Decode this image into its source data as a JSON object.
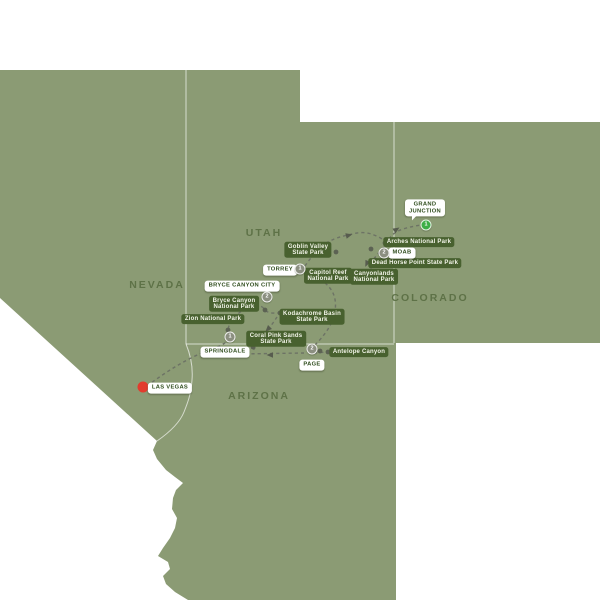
{
  "map": {
    "colors": {
      "land": "#8b9b74",
      "outside": "#ffffff",
      "state_border": "rgba(255,255,255,0.65)",
      "pill_bg": "#48612f",
      "pill_text": "#f2f4e8",
      "city_text": "#2f4d1d",
      "state_label": "#5e7247",
      "route_dash": "#6d7365",
      "stop_dot": "#5c6253",
      "arrow": "#575c4e",
      "badge_gray": "#8b8f80",
      "badge_green": "#3cae46",
      "start_red": "#e23b2d"
    },
    "state_labels": [
      {
        "id": "nevada",
        "name": "NEVADA",
        "x": 156,
        "y": 285
      },
      {
        "id": "utah",
        "name": "UTAH",
        "x": 263,
        "y": 233
      },
      {
        "id": "colorado",
        "name": "COLORADO",
        "x": 429,
        "y": 298
      },
      {
        "id": "arizona",
        "name": "ARIZONA",
        "x": 258,
        "y": 396
      }
    ],
    "park_labels": [
      {
        "id": "goblin-valley",
        "text": "Goblin Valley\nState Park",
        "x": 308,
        "y": 250
      },
      {
        "id": "capitol-reef",
        "text": "Capitol Reef\nNational Park",
        "x": 328,
        "y": 276
      },
      {
        "id": "arches",
        "text": "Arches National Park",
        "x": 419,
        "y": 242
      },
      {
        "id": "dead-horse-point",
        "text": "Dead Horse Point State Park",
        "x": 415,
        "y": 263
      },
      {
        "id": "canyonlands",
        "text": "Canyonlands\nNational Park",
        "x": 374,
        "y": 277
      },
      {
        "id": "kodachrome-basin",
        "text": "Kodachrome Basin\nState Park",
        "x": 312,
        "y": 317
      },
      {
        "id": "bryce-canyon-np",
        "text": "Bryce Canyon\nNational Park",
        "x": 234,
        "y": 304
      },
      {
        "id": "zion",
        "text": "Zion National Park",
        "x": 213,
        "y": 319
      },
      {
        "id": "coral-pink-sands",
        "text": "Coral Pink Sands\nState Park",
        "x": 276,
        "y": 339
      },
      {
        "id": "antelope-canyon",
        "text": "Antelope Canyon",
        "x": 359,
        "y": 352
      }
    ],
    "city_labels": [
      {
        "id": "grand-junction",
        "text": "GRAND\nJUNCTION",
        "x": 425,
        "y": 208,
        "tail": true
      },
      {
        "id": "moab",
        "text": "MOAB",
        "x": 402,
        "y": 253,
        "tail": false
      },
      {
        "id": "torrey",
        "text": "TORREY",
        "x": 280,
        "y": 270,
        "tail": false
      },
      {
        "id": "bryce-canyon-city",
        "text": "BRYCE CANYON CITY",
        "x": 242,
        "y": 286,
        "tail": false
      },
      {
        "id": "springdale",
        "text": "SPRINGDALE",
        "x": 225,
        "y": 352,
        "tail": false
      },
      {
        "id": "page",
        "text": "PAGE",
        "x": 312,
        "y": 365,
        "tail": false
      },
      {
        "id": "las-vegas",
        "text": "LAS VEGAS",
        "x": 170,
        "y": 388,
        "tail": false
      }
    ],
    "night_badges": [
      {
        "id": "grand-junction-nights",
        "nights": "1",
        "x": 426,
        "y": 225,
        "color": "green"
      },
      {
        "id": "moab-nights",
        "nights": "2",
        "x": 384,
        "y": 253,
        "color": "gray"
      },
      {
        "id": "torrey-nights",
        "nights": "1",
        "x": 300,
        "y": 269,
        "color": "gray"
      },
      {
        "id": "bryce-canyon-city-nights",
        "nights": "2",
        "x": 267,
        "y": 297,
        "color": "gray"
      },
      {
        "id": "springdale-nights",
        "nights": "1",
        "x": 230,
        "y": 337,
        "color": "gray"
      },
      {
        "id": "page-nights",
        "nights": "2",
        "x": 312,
        "y": 349,
        "color": "gray"
      }
    ],
    "start_city": {
      "id": "las-vegas-start",
      "x": 143,
      "y": 387
    },
    "route_stop_dots": [
      {
        "x": 228,
        "y": 330
      },
      {
        "x": 265,
        "y": 310
      },
      {
        "x": 280,
        "y": 313
      },
      {
        "x": 253,
        "y": 347
      },
      {
        "x": 320,
        "y": 351
      },
      {
        "x": 328,
        "y": 352
      },
      {
        "x": 305,
        "y": 271
      },
      {
        "x": 336,
        "y": 252
      },
      {
        "x": 385,
        "y": 243
      },
      {
        "x": 371,
        "y": 249
      },
      {
        "x": 375,
        "y": 260
      },
      {
        "x": 371,
        "y": 266
      }
    ],
    "route_arrows": [
      {
        "x": 270,
        "y": 327,
        "angle": 135
      },
      {
        "x": 273,
        "y": 355,
        "angle": 180
      },
      {
        "x": 346,
        "y": 236,
        "angle": -14
      },
      {
        "x": 368,
        "y": 261,
        "angle": 115
      },
      {
        "x": 394,
        "y": 231,
        "angle": -33
      }
    ],
    "route_paths": [
      {
        "id": "las-vegas-to-kodachrome",
        "d": "M147,386 C167,371 188,358 207,351 C217,347 224,345 228,340 C231,336 227,335 228,330 C229,321 237,313 247,308 C256,304 262,305 265,310 C269,314 274,313 279,313"
      },
      {
        "id": "bryce-to-coral-pink",
        "d": "M277,317 C273,323 268,330 263,337 C259,343 255,347 253,351"
      },
      {
        "id": "springdale-to-page",
        "d": "M239,354 L304,353"
      },
      {
        "id": "page-to-antelope",
        "d": "M314,353 L327,352"
      },
      {
        "id": "page-to-capitol-reef",
        "d": "M315,345 C322,338 330,328 333,319 C336,310 337,300 332,291 C327,283 317,276 307,271"
      },
      {
        "id": "torrey-to-arches",
        "d": "M305,266 C311,257 319,248 328,242 C337,237 344,236 352,234 C360,232 367,232 374,235 C379,237 383,239 385,242"
      },
      {
        "id": "arches-to-canyonlands",
        "d": "M384,247 C380,251 376,256 373,260 C372,262 371,264 371,266"
      },
      {
        "id": "moab-to-grand-junction",
        "d": "M389,239 C392,234 397,231 403,229 C409,227 415,226 421,225"
      }
    ],
    "geography": {
      "land_path": "M0,70 L300,70 L300,122 L600,122 L600,343 L396,343 L396,600 L188,600 L175,592 L166,584 L163,576 L170,569 L168,562 L158,556 L163,548 L170,538 L175,528 L177,518 L172,509 L173,498 L176,490 L183,483 L175,477 L166,470 L157,459 L153,450 L157,441 L0,298 Z",
      "border_nv_ut": "M186,70 L186,344",
      "border_ut_co": "M394,122 L394,343",
      "border_ut_az": "M186,344 L394,344",
      "border_nv_az_river": "M186,344 C191,356 193,368 192,380 C191,394 188,402 184,412 C180,422 170,432 157,441"
    }
  }
}
